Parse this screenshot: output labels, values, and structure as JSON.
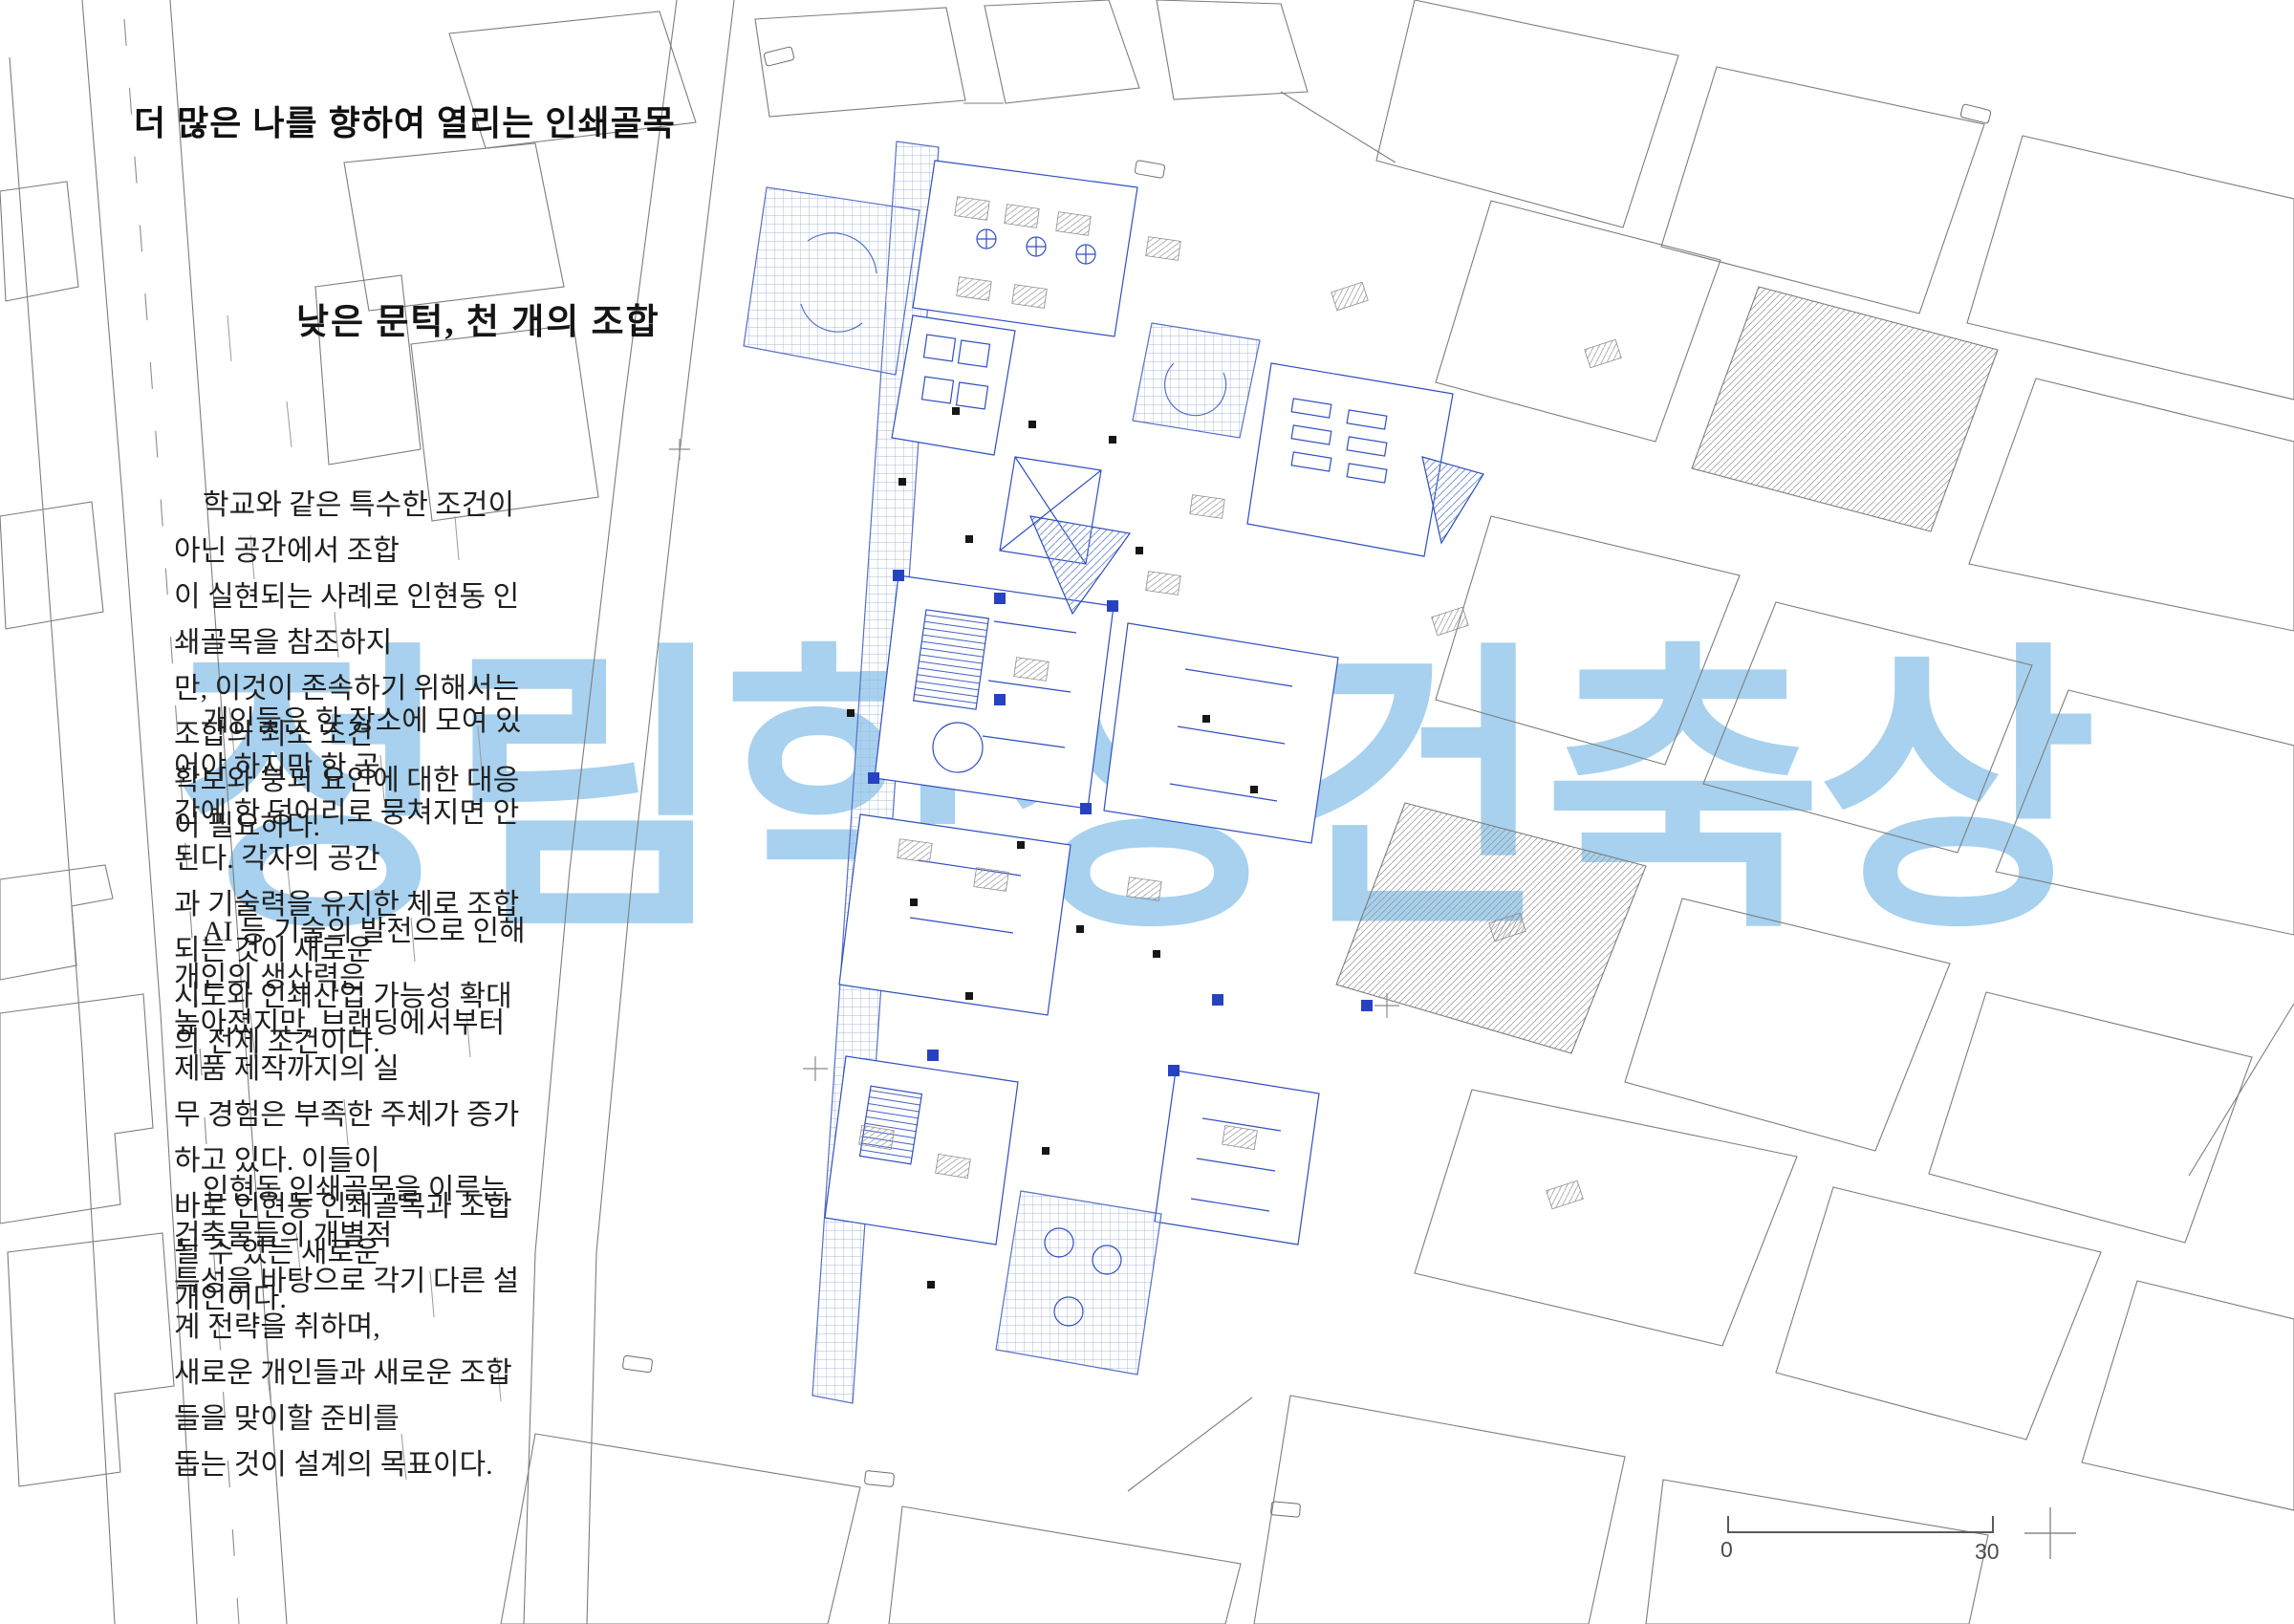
{
  "content": {
    "title": "더 많은 나를 향하여 열리는 인쇄골목",
    "subtitle": "낮은 문턱, 천 개의 조합",
    "paragraphs": [
      "학교와 같은 특수한 조건이 아닌 공간에서 조합\n이 실현되는 사례로 인현동 인쇄골목을 참조하지\n만, 이것이 존속하기 위해서는 조합의 최소 조건\n확보와 붕괴 요인에 대한 대응이 필요하다.",
      "개인들은 한 장소에 모여 있어야 하지만 한 공\n간에 한 덩어리로 뭉쳐지면 안 된다. 각자의 공간\n과 기술력을 유지한 체로 조합되는 것이 새로운\n시도와 인쇄산업 가능성 확대의 전제 조건이다.",
      "AI 등 기술의 발전으로 인해 개인의 생산력은\n높아졌지만, 브랜딩에서부터 제품 제작까지의 실\n무 경험은 부족한 주체가 증가하고 있다. 이들이\n바로 인현동 인쇄골목과 조합될 수 있는 새로운\n개인이다.",
      "인현동 인쇄골목을 이루는 건축물들의 개별적\n특성을 바탕으로 각기 다른 설계 전략을 취하며,\n새로운 개인들과 새로운 조합들을 맞이할 준비를\n돕는 것이 설계의 목표이다."
    ],
    "watermark": "정림학생건축상",
    "scale_bar": {
      "start_label": "0",
      "end_label": "30"
    },
    "colors": {
      "watermark_blue": "#a7d1ee",
      "cad_blue": "#2e4fc0",
      "pale_grid_blue": "#a3b8dc",
      "line_gray": "#7d7d7d",
      "text_black": "#1c1c1c"
    },
    "drawing_description": "site plan of Inhyeon-dong print alley with surrounding city blocks"
  }
}
